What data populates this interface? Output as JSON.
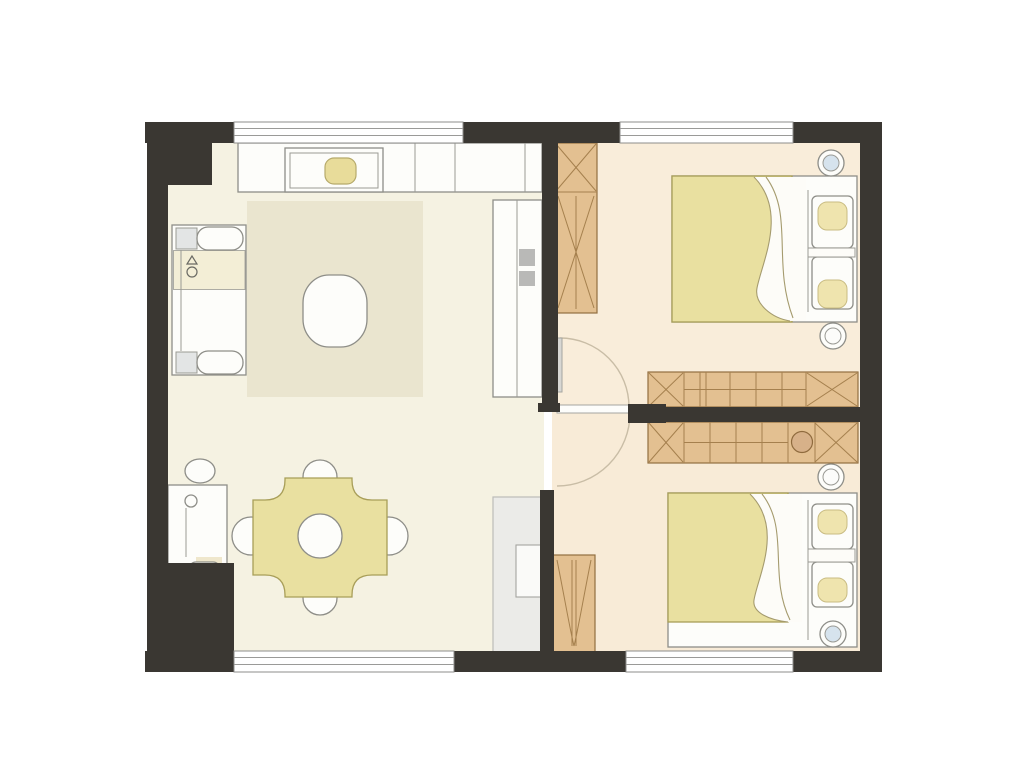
{
  "floor_plan": {
    "type": "residential-apartment-2-bedroom",
    "rooms": [
      {
        "name": "living-dining-room",
        "furniture": [
          "tv-console",
          "tv-screen",
          "media-item",
          "sofa",
          "area-rug",
          "coffee-table",
          "storage-cabinet",
          "counter-cabinet",
          "desk",
          "desk-chair",
          "side-plant",
          "dining-table",
          "dining-chair-top",
          "dining-chair-bottom",
          "dining-chair-left",
          "dining-chair-right"
        ]
      },
      {
        "name": "bedroom-top",
        "furniture": [
          "tall-wardrobe",
          "double-bed",
          "pillow-1",
          "pillow-2",
          "bedside-lamp-top",
          "bedside-lamp-bottom",
          "long-wardrobe",
          "swing-door"
        ]
      },
      {
        "name": "bedroom-bottom",
        "furniture": [
          "long-wardrobe",
          "round-mirror",
          "double-bed",
          "pillow-1",
          "pillow-2",
          "bedside-lamp-top",
          "bedside-lamp-bottom",
          "small-wardrobe",
          "swing-door"
        ]
      }
    ],
    "window_count": 4,
    "door_count": 2,
    "palette": {
      "wall": "#3a3732",
      "living_floor": "#f5f2e2",
      "bedroom_floor_top": "#f9edda",
      "bedroom_floor_bottom": "#f8ebd7",
      "rug": "#eae5cf",
      "furniture_white": "#fdfdfa",
      "outline_gray": "#8e8e88",
      "duvet_yellow": "#e9e0a0",
      "wood_tan": "#e3c091",
      "wood_line": "#926f40",
      "handle_gray": "#b9b9b7",
      "counter_gray": "#ebebe8",
      "lamp_blue": "#d6e3ed",
      "door_leaf_gray": "#d8d7d3",
      "door_arc": "#c9bda6"
    }
  }
}
